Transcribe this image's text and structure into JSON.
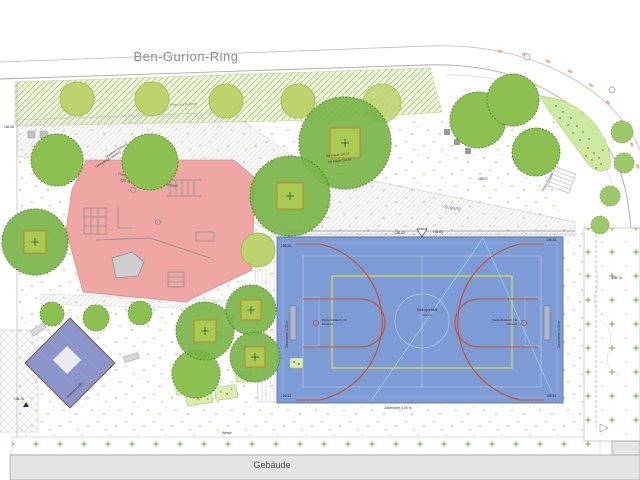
{
  "street": {
    "name": "Ben-Gurion-Ring"
  },
  "building": {
    "label": "Gebäude"
  },
  "playground": {
    "label": "Parkour- und Calisthenics-Bereich",
    "area": "220 m²",
    "trampoline_label": "Bodentrampolin",
    "benches_label": "Sitzbänke Bestand",
    "bike_racks_label": "Fahrradbügel Bestand"
  },
  "court": {
    "center_label": "Kleinspielfeld",
    "center_area": "430 m²",
    "fence_label": "Zaunhöhe 4.00 m",
    "hoop_label_line1": "Basketballkorb mit",
    "hoop_label_line2": "Zielbrett"
  },
  "labels": {
    "zugang": "Zugang",
    "wiese": "Wiese",
    "pflanzung": "Pflanzung Bestand",
    "ok_mauer_1": "OK Mauer 137.17",
    "ok_mauer_2": "UK Mauer 136.99",
    "treppe": "Treppe Bestand"
  },
  "elevations": {
    "e1": "136.15",
    "e2": "136.43",
    "e3": "136.84",
    "e4": "136.28",
    "e5": "136.13",
    "e6": "136.40",
    "e7": "136.07",
    "e8": "136.08",
    "e9": "136.74",
    "e10": "136.26"
  },
  "colors": {
    "court_blue": "#7d9bd5",
    "court_red": "#c8502f",
    "court_yellow": "#d8dd55",
    "playground_pink": "#efa7a4",
    "tree_light": "#bdd36e",
    "tree_mid": "#8cc152",
    "diamond_blue": "#8b95c9",
    "bed_green": "#d9edb5",
    "building_grey": "#e4e4e4",
    "meadow_dot_green": "#74b043",
    "street_text_grey": "#8c8c8c"
  }
}
